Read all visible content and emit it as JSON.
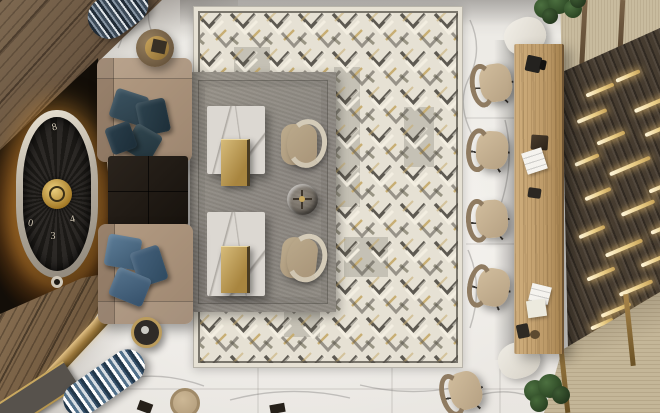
{
  "meta": {
    "title": "Top-view 3D interior render — hotel lounge and reception",
    "view": "bird's-eye / plan view, no UI chrome or text overlays"
  },
  "palette": {
    "marble": "#ebe8e3",
    "rug-cream": "#e6e1d4",
    "rug-border": "#55524a",
    "chevron-dark": "#56524a",
    "chevron-cream": "#f4efe2",
    "chevron-gold": "#c6ab6e",
    "chevron-gray": "#94907f",
    "rug-gray": "#8b8680",
    "sofa-beige": "#9d8670",
    "pillow-teal": "#2c3f4a",
    "pillow-blue": "#46637e",
    "ottoman-dark": "#17120d",
    "table-marble": "#dcd8d2",
    "tray-gold": "#a8853f",
    "armchair-beige": "#a89478",
    "wall-dark": "#130e08",
    "glow-amber": "#ec9832",
    "wood-panel": "#64503c",
    "wood-console": "#71593e",
    "brass": "#977438",
    "desk-oak": "#bb9866",
    "slat-wall": "#463c30",
    "gold-bar": "#ecd08a",
    "travertine": "#c8bb9e",
    "chair-beige": "#b5a082",
    "plant-green": "#2c4724",
    "stripe-blue": "#51708a",
    "stripe-navy": "#3c4a58",
    "clock-silver": "#b6aea0",
    "clock-gold": "#a67c28"
  },
  "clock": {
    "numerals": [
      "8",
      "0",
      "3",
      "4"
    ]
  },
  "objects": [
    "white marble tile floor with gray veining",
    "large cream rug with black, taupe and gold chevron pattern",
    "gray layered rug",
    "two square marble coffee tables with brass nesting trays",
    "two curved beige lounge chairs",
    "round bronze-and-glass side table",
    "two beige sofas with teal and steel-blue pillows",
    "dark leather square ottoman",
    "illuminated tonneau wall clock on dark feature wall",
    "diagonal dark-wood wall panels and console with brass edge",
    "two striped cylindrical ottomans",
    "round wood drum side table with brass tray",
    "round black side table with gold rim",
    "long light-oak reception desk with papers and devices",
    "five beige swivel task chairs on casters",
    "dark slatted wood wall with glowing brass light bars",
    "travertine wall panels with wood strips",
    "two green potted plants"
  ]
}
